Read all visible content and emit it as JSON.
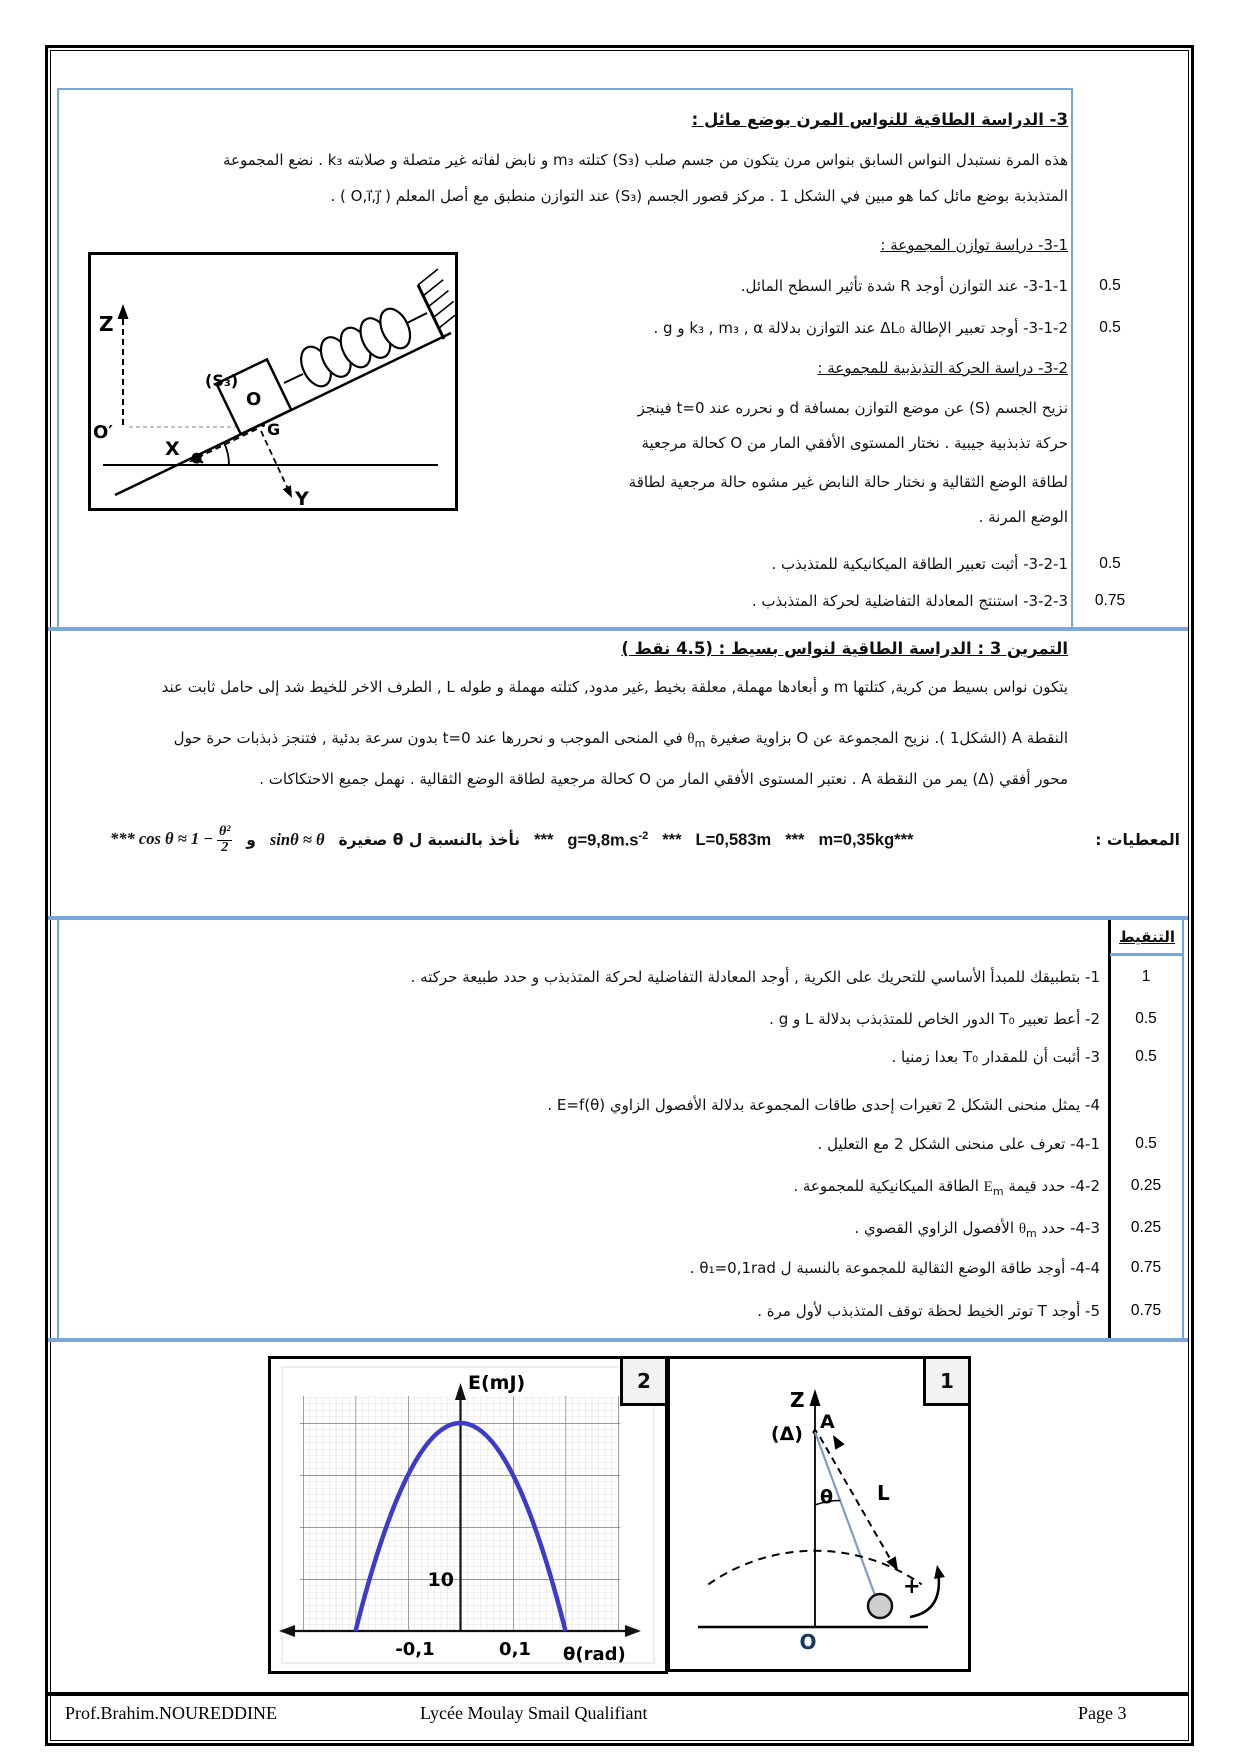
{
  "accent_blue": "#6fa8dc",
  "curve_blue": "#3c3ccc",
  "section3": {
    "title": "3- الدراسة الطاقية للنواس المرن بوضع مائل :",
    "p1_l1": "هذه المرة نستبدل النواس السابق بنواس مرن يتكون من جسم صلب (S₃) كتلته m₃ و نابض لفاته غير متصلة و صلابته k₃ . نضع المجموعة",
    "p1_l2": "المتذبذبة بوضع مائل كما هو مبين في الشكل 1 . مركز قصور الجسم (S₃) عند التوازن منطبق مع أصل المعلم ( O,i⃗,j⃗ ) .",
    "sub1_heading": "3-1- دراسة توازن المجموعة :",
    "q311": {
      "text": "3-1-1- عند التوازن أوجد R شدة تأثير السطح المائل.",
      "score": "0.5"
    },
    "q312": {
      "text": "3-1-2- أوجد تعبير الإطالة ΔL₀ عند التوازن بدلالة k₃ , m₃ , α و g .",
      "score": "0.5"
    },
    "sub2_heading": "3-2- دراسة الحركة التذبذبية للمجموعة :",
    "para_l1": "نزيح الجسم (S) عن موضع التوازن بمسافة d و نحرره عند t=0 فينجز",
    "para_l2": "حركة تذبذبية جيبية . نختار المستوى الأفقي المار من O كحالة مرجعية",
    "para_l3": "لطاقة الوضع الثقالية و نختار حالة النابض غير مشوه حالة مرجعية لطاقة",
    "para_l4": "الوضع المرنة .",
    "q321": {
      "text": "3-2-1- أثبت تعبير الطاقة الميكانيكية للمتذبذب .",
      "score": "0.5"
    },
    "q323": {
      "text": "3-2-3- استنتج المعادلة التفاضلية لحركة المتذبذب .",
      "score": "0.75"
    }
  },
  "figureA": {
    "z": "Z",
    "o_prime": "O′",
    "s3": "(S₃)",
    "o": "O",
    "g": "G",
    "x": "X",
    "y": "Y",
    "alpha": "α"
  },
  "exercise3": {
    "title": "التمرين 3 : الدراسة الطاقية لنواس بسيط : (4.5 نقط )",
    "para_l1": "يتكون نواس بسيط من كرية, كتلتها m و أبعادها مهملة, معلقة بخيط ,غير مدود, كتلته مهملة و طوله L , الطرف الاخر للخيط شد إلى حامل ثابت عند",
    "para_l2_pre": "النقطة A (الشكل1 ). نزيح المجموعة عن O بزاوية صغيرة ",
    "para_sym": "θ",
    "para_sub": "m",
    "para_l2_post": " في المنحى الموجب و نحررها عند t=0 بدون سرعة بدئية , فتنجز ذبذبات حرة حول",
    "para_l3": "محور أفقي (Δ) يمر من النقطة A . نعتبر المستوى الأفقي المار من O كحالة مرجعية لطاقة الوضع الثقالية . نهمل جميع الاحتكاكات .",
    "dl": {
      "cos_pre": "*** cos θ ≈ 1 −",
      "frac_num": "θ²",
      "frac_den": "2",
      "and": "و",
      "sin": "sinθ ≈ θ",
      "small_phrase": "نأخذ بالنسبة ل θ صغيرة",
      "stars": "***",
      "g": "g=9,8m.s",
      "g_exp": "-2",
      "L": "L=0,583m",
      "m": "m=0,35kg***",
      "label": "المعطيات :"
    },
    "grading_header": "التنقيط",
    "questions": [
      {
        "pre": "1- بتطبيقك للمبدأ الأساسي للتحريك على الكرية , أوجد المعادلة التفاضلية لحركة المتذبذب و حدد طبيعة حركته .",
        "sym": "",
        "sub": "",
        "post": "",
        "score": "1"
      },
      {
        "pre": "2- أعط تعبير T₀ الدور الخاص للمتذبذب بدلالة L و g .",
        "sym": "",
        "sub": "",
        "post": "",
        "score": "0.5"
      },
      {
        "pre": "3- أثبت أن للمقدار T₀ بعدا زمنيا .",
        "sym": "",
        "sub": "",
        "post": "",
        "score": "0.5"
      },
      {
        "pre": "4- يمثل منحنى الشكل 2 تغيرات إحدى طاقات المجموعة بدلالة الأفصول الزاوي E=f(θ) .",
        "sym": "",
        "sub": "",
        "post": "",
        "score": ""
      },
      {
        "pre": "4-1- تعرف على منحنى الشكل 2 مع التعليل .",
        "sym": "",
        "sub": "",
        "post": "",
        "score": "0.5"
      },
      {
        "pre": "4-2- حدد قيمة ",
        "sym": "E",
        "sub": "m",
        "post": " الطاقة الميكانيكية للمجموعة .",
        "score": "0.25"
      },
      {
        "pre": "4-3- حدد ",
        "sym": "θ",
        "sub": "m",
        "post": " الأفصول الزاوي القصوي .",
        "score": "0.25"
      },
      {
        "pre": "4-4- أوجد طاقة الوضع الثقالية للمجموعة بالنسبة ل θ₁=0,1rad .",
        "sym": "",
        "sub": "",
        "post": "",
        "score": "0.75"
      },
      {
        "pre": "5- أوجد T توتر الخيط لحظة توقف المتذبذب لأول مرة .",
        "sym": "",
        "sub": "",
        "post": "",
        "score": "0.75"
      }
    ]
  },
  "figure1": {
    "tag": "1",
    "z": "Z",
    "delta": "(Δ)",
    "a": "A",
    "theta": "θ",
    "l": "L",
    "plus": "+",
    "o": "O"
  },
  "figure2": {
    "tag": "2"
  },
  "chart_data": {
    "type": "line",
    "title": "الشكل 2 : منحنى طاقة بدلالة الأفصول الزاوي E=f(θ)",
    "xlabel": "θ(rad)",
    "ylabel": "E(mJ)",
    "xtick_labels": [
      "-0,1",
      "0,1"
    ],
    "ytick_label": "10",
    "x_major_step_rad": 0.1,
    "y_major_step_mJ": 10,
    "xlim": [
      -0.35,
      0.35
    ],
    "ylim": [
      0,
      45
    ],
    "grid": true,
    "curve_shape": "inverted parabola E = 40 - 1000·θ²  (mJ, θ in rad)",
    "peak_E_mJ": 40,
    "zeros_theta_rad": [
      -0.2,
      0.2
    ],
    "series": [
      {
        "name": "E",
        "points": [
          [
            -0.2,
            0
          ],
          [
            -0.15,
            17.5
          ],
          [
            -0.1,
            30
          ],
          [
            -0.05,
            37.5
          ],
          [
            0,
            40
          ],
          [
            0.05,
            37.5
          ],
          [
            0.1,
            30
          ],
          [
            0.15,
            17.5
          ],
          [
            0.2,
            0
          ]
        ]
      }
    ],
    "legend": "none"
  },
  "footer": {
    "left": "Prof.Brahim.NOUREDDINE",
    "center": "Lycée Moulay Smail Qualifiant",
    "right": "Page 3"
  }
}
